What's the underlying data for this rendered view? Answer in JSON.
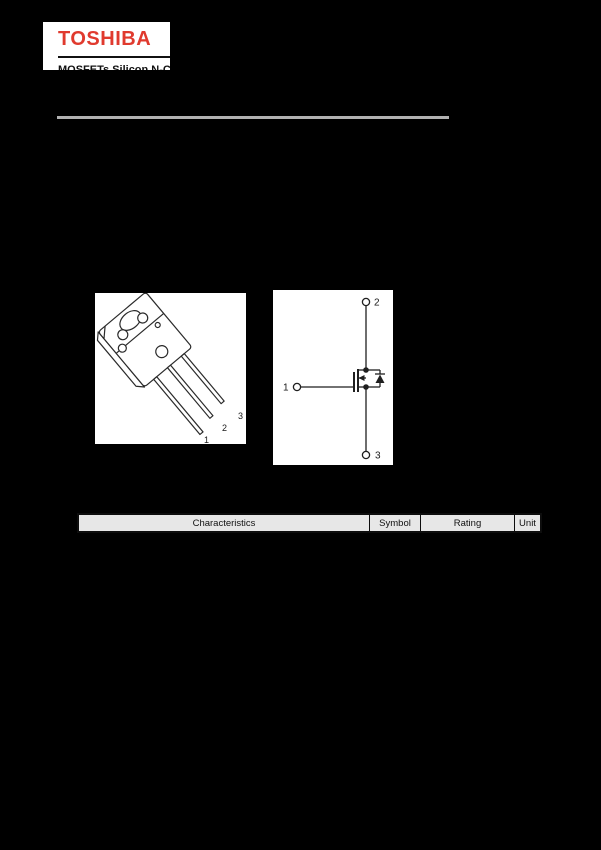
{
  "page": {
    "background_color": "#000000"
  },
  "logo": {
    "brand": "TOSHIBA",
    "brand_color": "#e03a2e",
    "subtitle_partial": "MOSFETs  Silicon N-C"
  },
  "divider": {
    "color": "#b1b1b1"
  },
  "package_figure": {
    "pins": [
      "1",
      "2",
      "3"
    ]
  },
  "symbol_figure": {
    "pins": [
      "1",
      "2",
      "3"
    ]
  },
  "table": {
    "header_fill": "#e7e7e7",
    "headers": [
      "Characteristics",
      "Symbol",
      "Rating",
      "Unit"
    ]
  }
}
